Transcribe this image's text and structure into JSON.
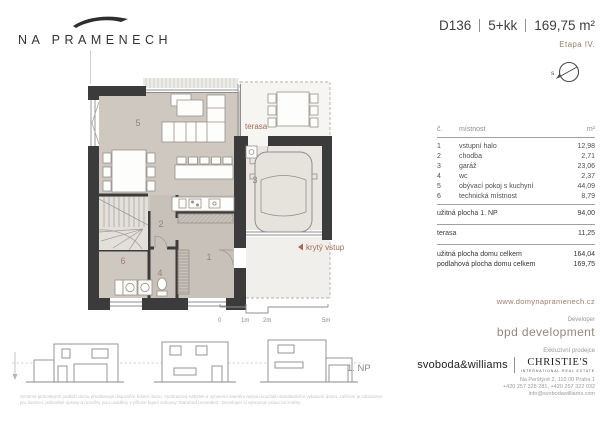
{
  "logo": {
    "name": "NA PRAMENECH"
  },
  "header": {
    "title_parts": [
      "D136",
      "5+kk",
      "169,75 m²"
    ],
    "stage": "Etapa IV.",
    "compass_label": "s"
  },
  "plan": {
    "room_numbers": [
      "1",
      "2",
      "3",
      "4",
      "5",
      "6"
    ],
    "terasa_label": "terasa",
    "entry_label": "krytý vstup",
    "floor_label": "1. NP",
    "scale": {
      "t0": "0",
      "t1": "1m",
      "t2": "2m",
      "t5": "5m"
    }
  },
  "table": {
    "headers": {
      "no": "č.",
      "room": "místnost",
      "area": "m²"
    },
    "rows": [
      {
        "no": "1",
        "room": "vstupní halo",
        "area": "12,98"
      },
      {
        "no": "2",
        "room": "chodba",
        "area": "2,71"
      },
      {
        "no": "3",
        "room": "garáž",
        "area": "23,06"
      },
      {
        "no": "4",
        "room": "wc",
        "area": "2,37"
      },
      {
        "no": "5",
        "room": "obývací pokoj s kuchyní",
        "area": "44,09"
      },
      {
        "no": "6",
        "room": "technická místnost",
        "area": "8,79"
      }
    ],
    "subtotal": {
      "label": "užitná plocha 1. NP",
      "value": "94,00"
    },
    "terrace": {
      "label": "terasa",
      "value": "11,25"
    },
    "totals": [
      {
        "label": "užitná plocha domu celkem",
        "value": "164,04"
      },
      {
        "label": "podlahová plocha domu celkem",
        "value": "169,75"
      }
    ]
  },
  "footer": {
    "website": "www.domynapramenech.cz",
    "developer_label": "Developer",
    "developer_name": "bpd development",
    "seller_label": "Exkluzivní prodejce",
    "seller_1": "svoboda&williams",
    "seller_2": "CHRISTIE'S",
    "seller_2_sub": "INTERNATIONAL REAL ESTATE",
    "address_line": "Na Perštýně 2, 110 00 Praha 1",
    "phones_line": "+420 257 328 281, +420 257 322 032",
    "email_line": "info@svobodawilliams.com",
    "disclaimer_1": "Schéma jednotlivých podlaží domu představuje dispoziční řešení domu. Vyobrazený nábytek a vybavení interiéru nejsou součástí standardního vybavení domu, zařízení je zobrazeno",
    "disclaimer_2": "pro ilustraci, jednotlivé úpravy a rozměry jsou uváděny v příloze kupní smlouvy 'Standard provedení'. Developer si vyhrazuje právo na změny."
  },
  "colors": {
    "accent": "#9c7e6d",
    "plan_label": "#a56a57",
    "room_number": "#9b8072",
    "wall": "#3b3b3b",
    "floor_living": "#cfc8c1",
    "floor_hall": "#c8c1b9",
    "floor_garage": "#e9e6e1"
  }
}
